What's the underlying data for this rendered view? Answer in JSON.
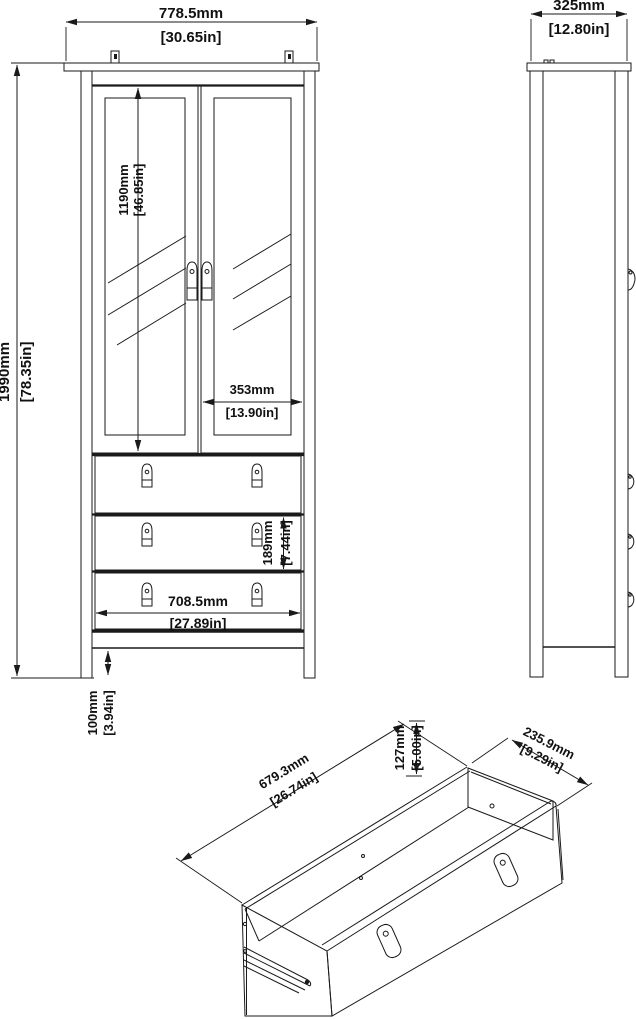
{
  "dims": {
    "front_width": {
      "mm": "778.5mm",
      "in": "[30.65in]"
    },
    "front_height": {
      "mm": "1990mm",
      "in": "[78.35in]"
    },
    "door_height": {
      "mm": "1190mm",
      "in": "[46.85in]"
    },
    "door_width": {
      "mm": "353mm",
      "in": "[13.90in]"
    },
    "drawer_front_height": {
      "mm": "189mm",
      "in": "[7.44in]"
    },
    "drawer_front_width": {
      "mm": "708.5mm",
      "in": "[27.89in]"
    },
    "leg_height": {
      "mm": "100mm",
      "in": "[3.94in]"
    },
    "side_depth": {
      "mm": "325mm",
      "in": "[12.80in]"
    },
    "drawer_length": {
      "mm": "679.3mm",
      "in": "[26.74in]"
    },
    "drawer_height": {
      "mm": "127mm",
      "in": "[5.00in]"
    },
    "drawer_depth": {
      "mm": "235.9mm",
      "in": "[9.29in]"
    }
  },
  "colors": {
    "line": "#1a1a1a",
    "background": "#ffffff"
  }
}
